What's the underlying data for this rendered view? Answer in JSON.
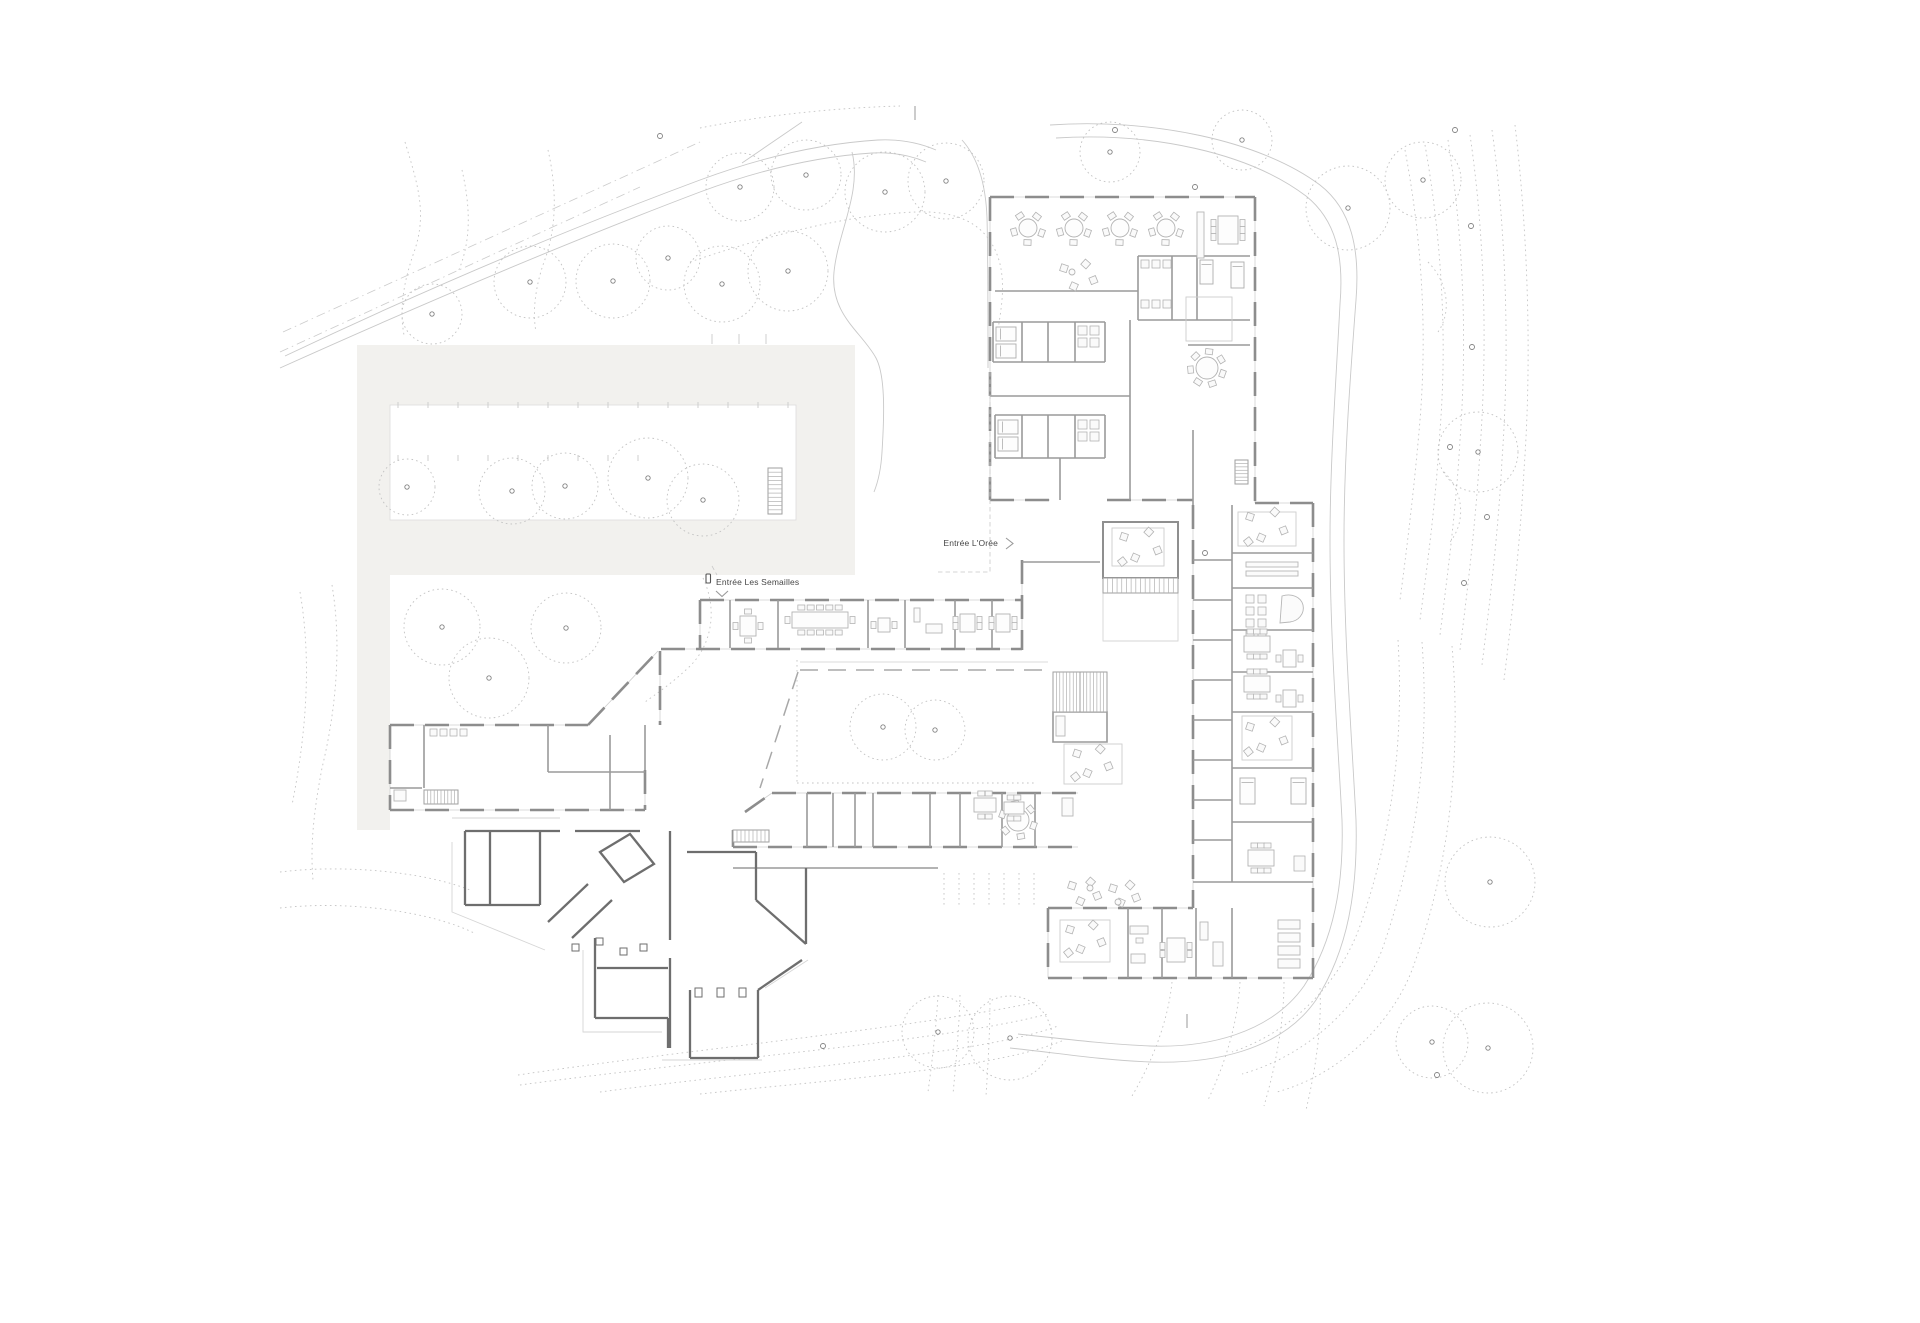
{
  "title": "Site / ground floor plan drawing",
  "labels": {
    "entrance_oree": "Entrée L'Orée",
    "entrance_semailles": "Entrée Les Semailles"
  },
  "colors": {
    "background": "#ffffff",
    "wall": "#8d8d8d",
    "wall_dark": "#6e6e6e",
    "partition": "#9a9a9a",
    "window": "#cfcfcf",
    "contour_dots": "#c4c4c4",
    "site_fill": "#f2f1ee",
    "furniture": "#b3b3b3",
    "text": "#474747"
  },
  "site": {
    "trees": [
      [
        432,
        314,
        30
      ],
      [
        530,
        282,
        36
      ],
      [
        613,
        281,
        37
      ],
      [
        668,
        258,
        32
      ],
      [
        740,
        187,
        34
      ],
      [
        806,
        175,
        35
      ],
      [
        885,
        192,
        40
      ],
      [
        946,
        181,
        38
      ],
      [
        788,
        271,
        40
      ],
      [
        722,
        284,
        38
      ],
      [
        407,
        487,
        28
      ],
      [
        512,
        491,
        33
      ],
      [
        565,
        486,
        33
      ],
      [
        648,
        478,
        40
      ],
      [
        703,
        500,
        36
      ],
      [
        442,
        627,
        38
      ],
      [
        566,
        628,
        35
      ],
      [
        489,
        678,
        40
      ],
      [
        883,
        727,
        33
      ],
      [
        935,
        730,
        30
      ],
      [
        1110,
        152,
        30
      ],
      [
        1242,
        140,
        30
      ],
      [
        1348,
        208,
        42
      ],
      [
        1423,
        180,
        38
      ],
      [
        1478,
        452,
        40
      ],
      [
        1490,
        882,
        45
      ],
      [
        1432,
        1042,
        36
      ],
      [
        1488,
        1048,
        45
      ],
      [
        938,
        1032,
        36
      ],
      [
        1010,
        1038,
        42
      ]
    ],
    "markers": [
      [
        660,
        136
      ],
      [
        1115,
        130
      ],
      [
        1195,
        187
      ],
      [
        1455,
        130
      ],
      [
        1471,
        226
      ],
      [
        1472,
        347
      ],
      [
        1450,
        447
      ],
      [
        1487,
        517
      ],
      [
        1464,
        583
      ],
      [
        1205,
        553
      ],
      [
        1437,
        1075
      ],
      [
        823,
        1046
      ]
    ],
    "ticks": [
      [
        915,
        106,
        915,
        120
      ],
      [
        1187,
        1014,
        1187,
        1028
      ]
    ],
    "parking_tick_rows": [
      {
        "y1": 402,
        "y2": 408,
        "x0": 398,
        "x1": 788,
        "step": 30
      },
      {
        "y1": 455,
        "y2": 461,
        "x0": 398,
        "x1": 638,
        "step": 30
      },
      {
        "y1": 334,
        "y2": 344,
        "x0": 712,
        "x1": 792,
        "step": 27
      }
    ]
  }
}
